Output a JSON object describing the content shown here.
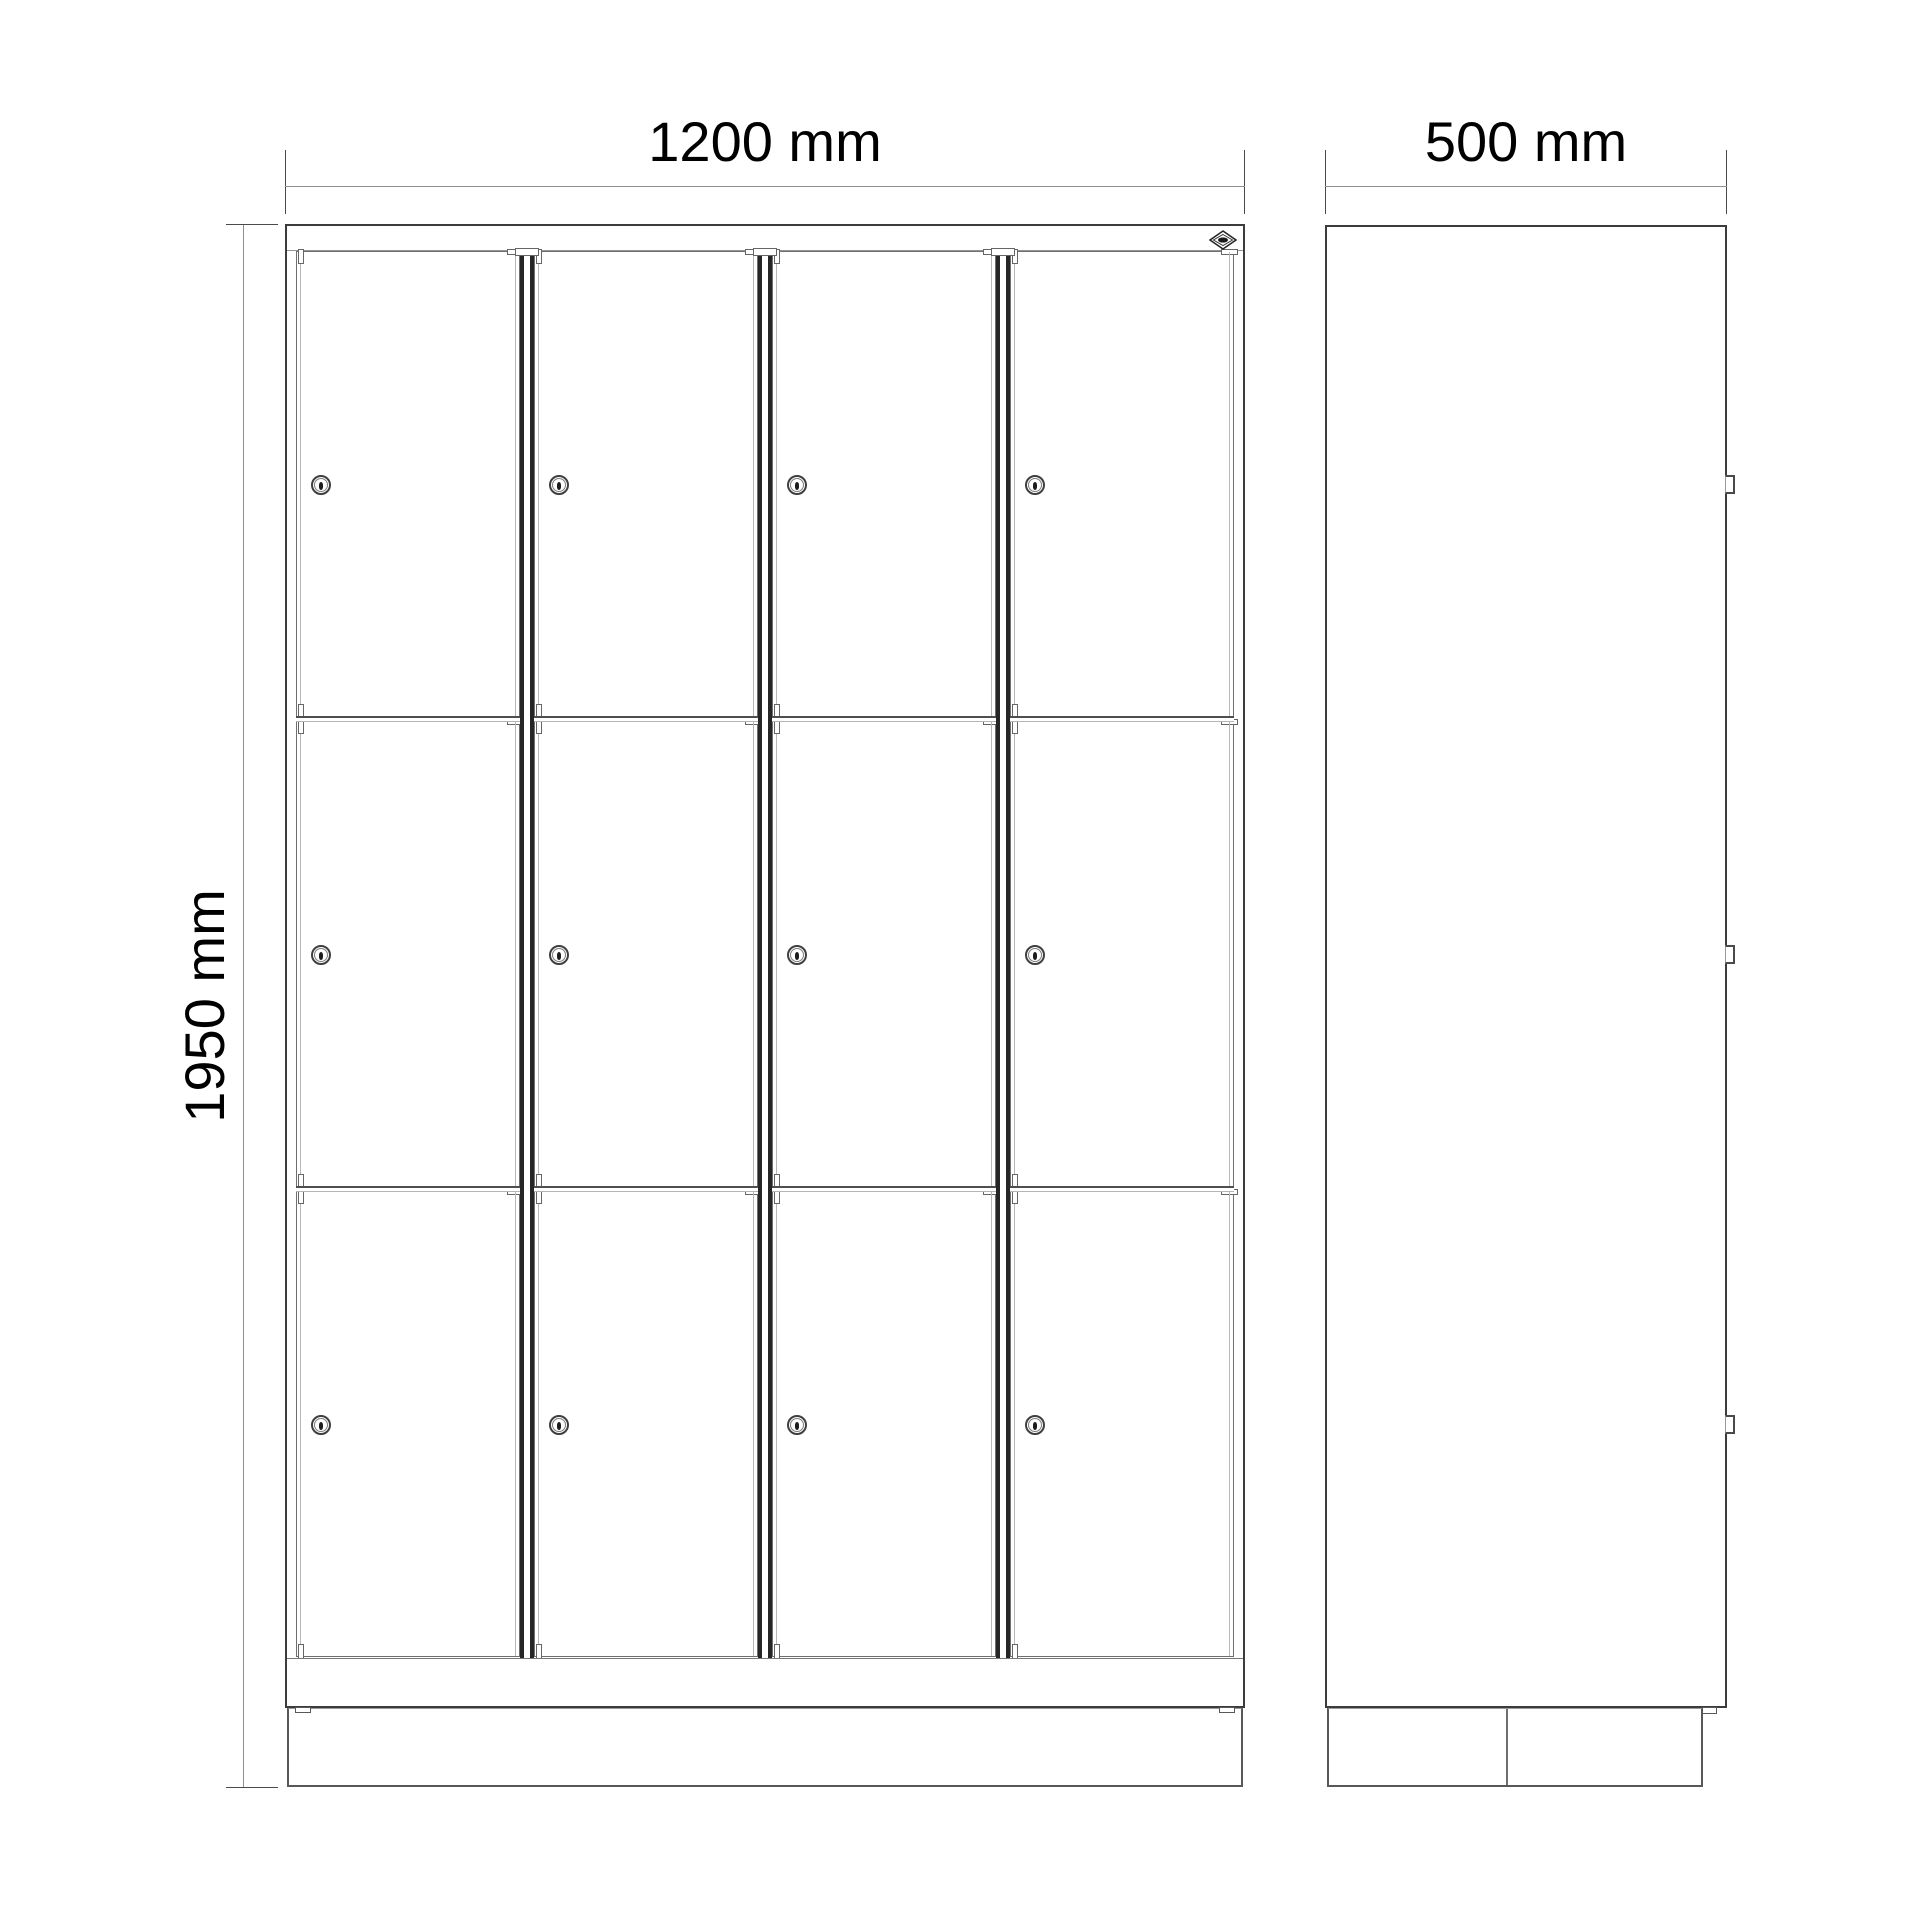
{
  "drawing": {
    "title_visible_text": [],
    "background_color": "#ffffff",
    "line_color": "#3c3c3c",
    "dim_line_color": "#8f8f8f",
    "dimensions": {
      "width": {
        "label": "1200 mm",
        "value": 1200,
        "unit": "mm",
        "orientation": "horizontal",
        "applies_to": "front-view"
      },
      "depth": {
        "label": "500 mm",
        "value": 500,
        "unit": "mm",
        "orientation": "horizontal",
        "applies_to": "side-view"
      },
      "height": {
        "label": "1950 mm",
        "value": 1950,
        "unit": "mm",
        "orientation": "vertical-rotated-90",
        "applies_to": "front-view"
      }
    },
    "views": {
      "front": {
        "name": "front view",
        "columns": 4,
        "rows": 3,
        "compartments": 12,
        "features": [
          "cylinder-lock on each door",
          "double-line mullions between columns",
          "row separator rails",
          "top rail",
          "bottom rail",
          "plinth base",
          "manufacturer diamond logo top right"
        ]
      },
      "side": {
        "name": "side view",
        "hinge_count": 3,
        "features": [
          "plain panel",
          "3 hinge brackets on right edge",
          "plinth base with center divider and corner bracket"
        ]
      }
    },
    "icons": {
      "lock": "cylinder-lock-icon",
      "hinge": "hinge-bracket-icon",
      "logo": "manufacturer-diamond-logo-icon"
    }
  }
}
